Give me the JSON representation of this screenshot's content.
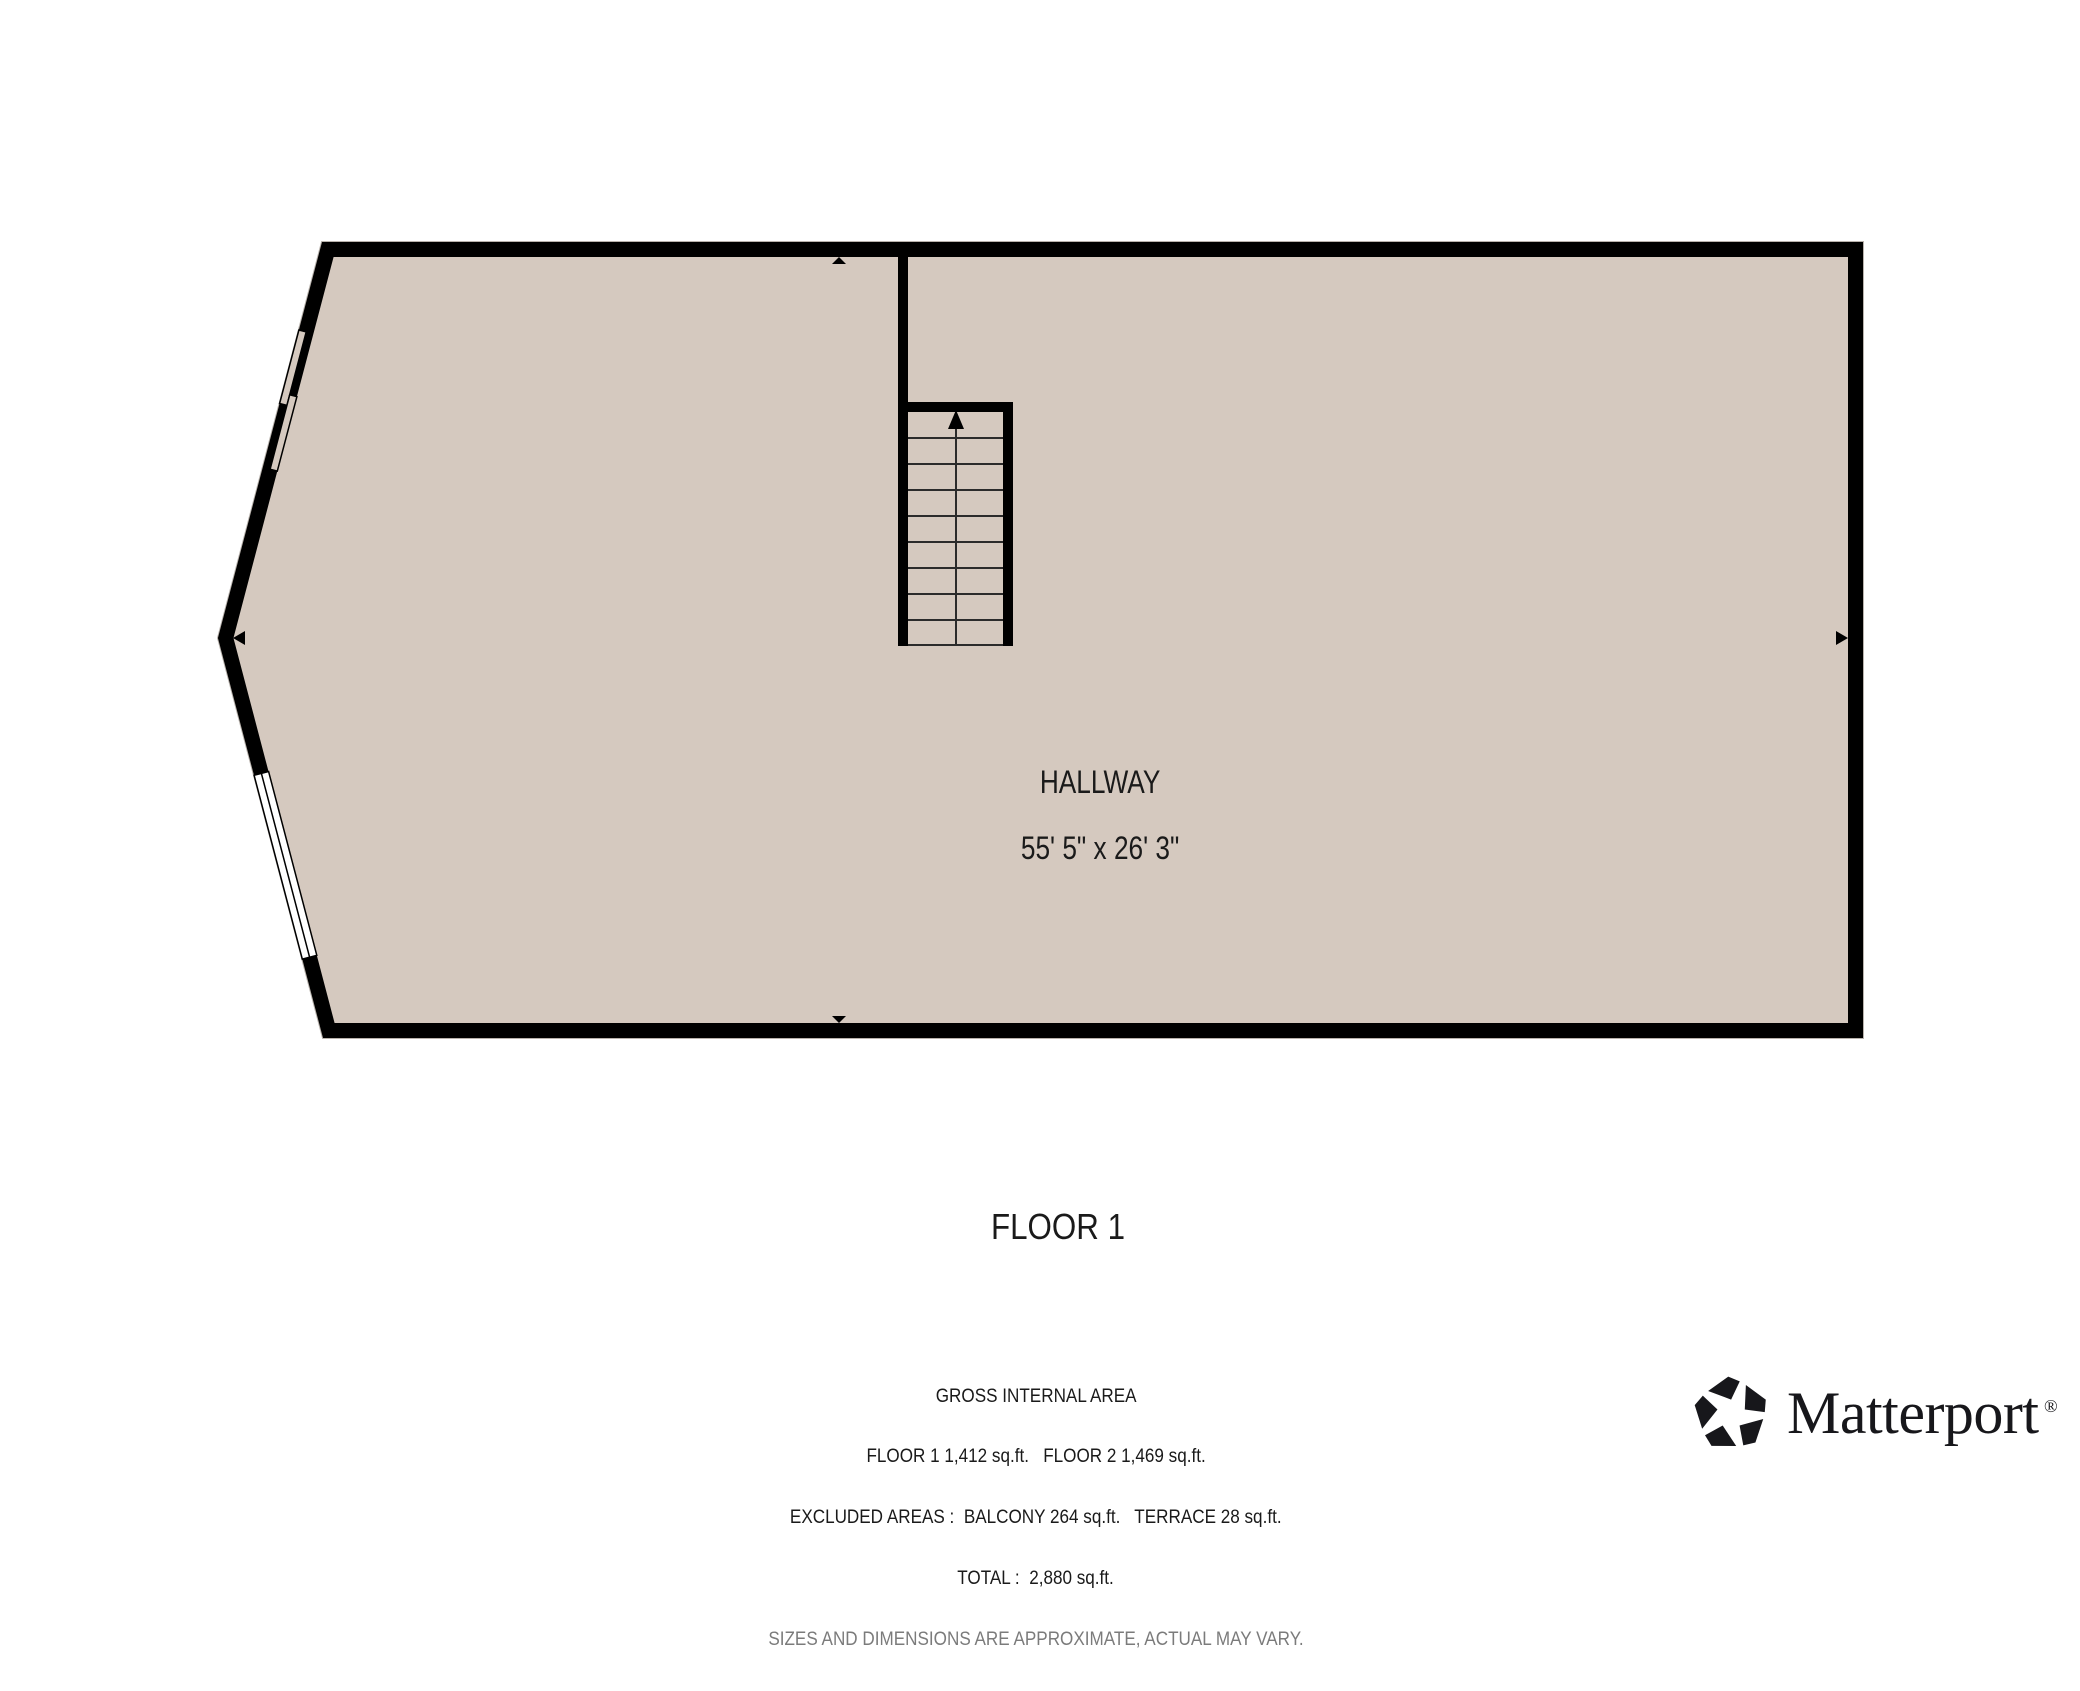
{
  "colors": {
    "background": "#ffffff",
    "floor_fill": "#d5c9bf",
    "wall": "#000000",
    "text": "#1a1a1a",
    "muted_text": "#7b7b7b",
    "window_fill": "#ffffff",
    "logo": "#17171b"
  },
  "plan": {
    "room": {
      "name": "HALLWAY",
      "dimensions": "55' 5\" x 26' 3\""
    }
  },
  "floor_title": "FLOOR 1",
  "footer": {
    "area_lines": [
      "GROSS INTERNAL AREA",
      "FLOOR 1 1,412 sq.ft.   FLOOR 2 1,469 sq.ft.",
      "EXCLUDED AREAS :  BALCONY 264 sq.ft.   TERRACE 28 sq.ft.",
      "TOTAL :  2,880 sq.ft."
    ],
    "disclaimer": "SIZES AND DIMENSIONS ARE APPROXIMATE, ACTUAL MAY VARY."
  },
  "logo": {
    "wordmark": "Matterport",
    "registered": "®"
  }
}
